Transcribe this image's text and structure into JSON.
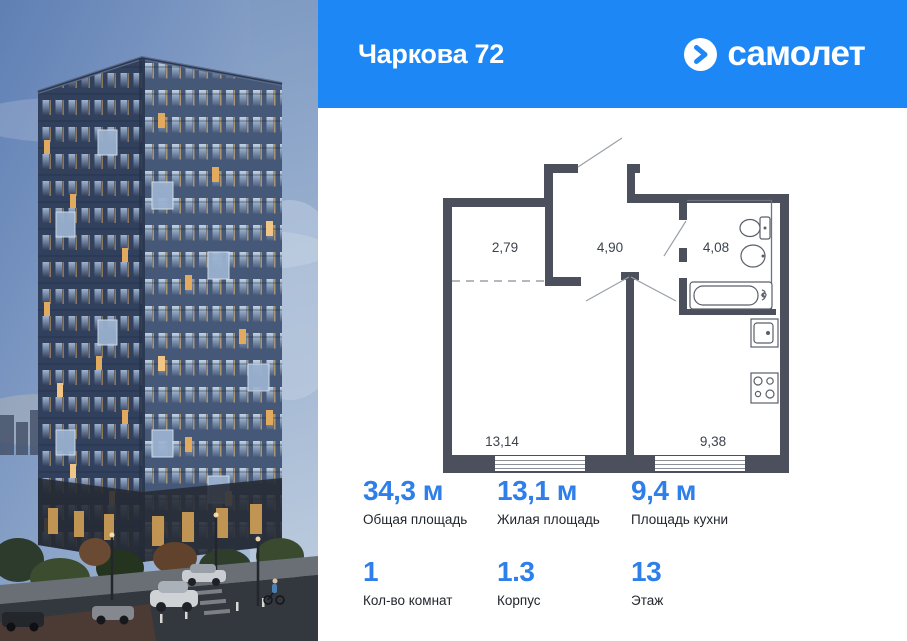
{
  "header": {
    "title": "Чаркова 72",
    "brand_name": "самолет",
    "bg_color": "#1d87f6"
  },
  "plan": {
    "wall_color": "#4b505c",
    "rooms": [
      {
        "name": "hallway-upper",
        "area": "2,79"
      },
      {
        "name": "hall",
        "area": "4,90"
      },
      {
        "name": "bathroom",
        "area": "4,08"
      },
      {
        "name": "living-room",
        "area": "13,14"
      },
      {
        "name": "kitchen",
        "area": "9,38"
      }
    ]
  },
  "stats": [
    {
      "value": "34,3 м",
      "label": "Общая площадь"
    },
    {
      "value": "13,1 м",
      "label": "Жилая площадь"
    },
    {
      "value": "9,4 м",
      "label": "Площадь кухни"
    },
    {
      "value": "1",
      "label": "Кол-во комнат"
    },
    {
      "value": "1.3",
      "label": "Корпус"
    },
    {
      "value": "13",
      "label": "Этаж"
    }
  ],
  "colors": {
    "accent_value": "#2e7fe9",
    "label_text": "#22262d"
  }
}
